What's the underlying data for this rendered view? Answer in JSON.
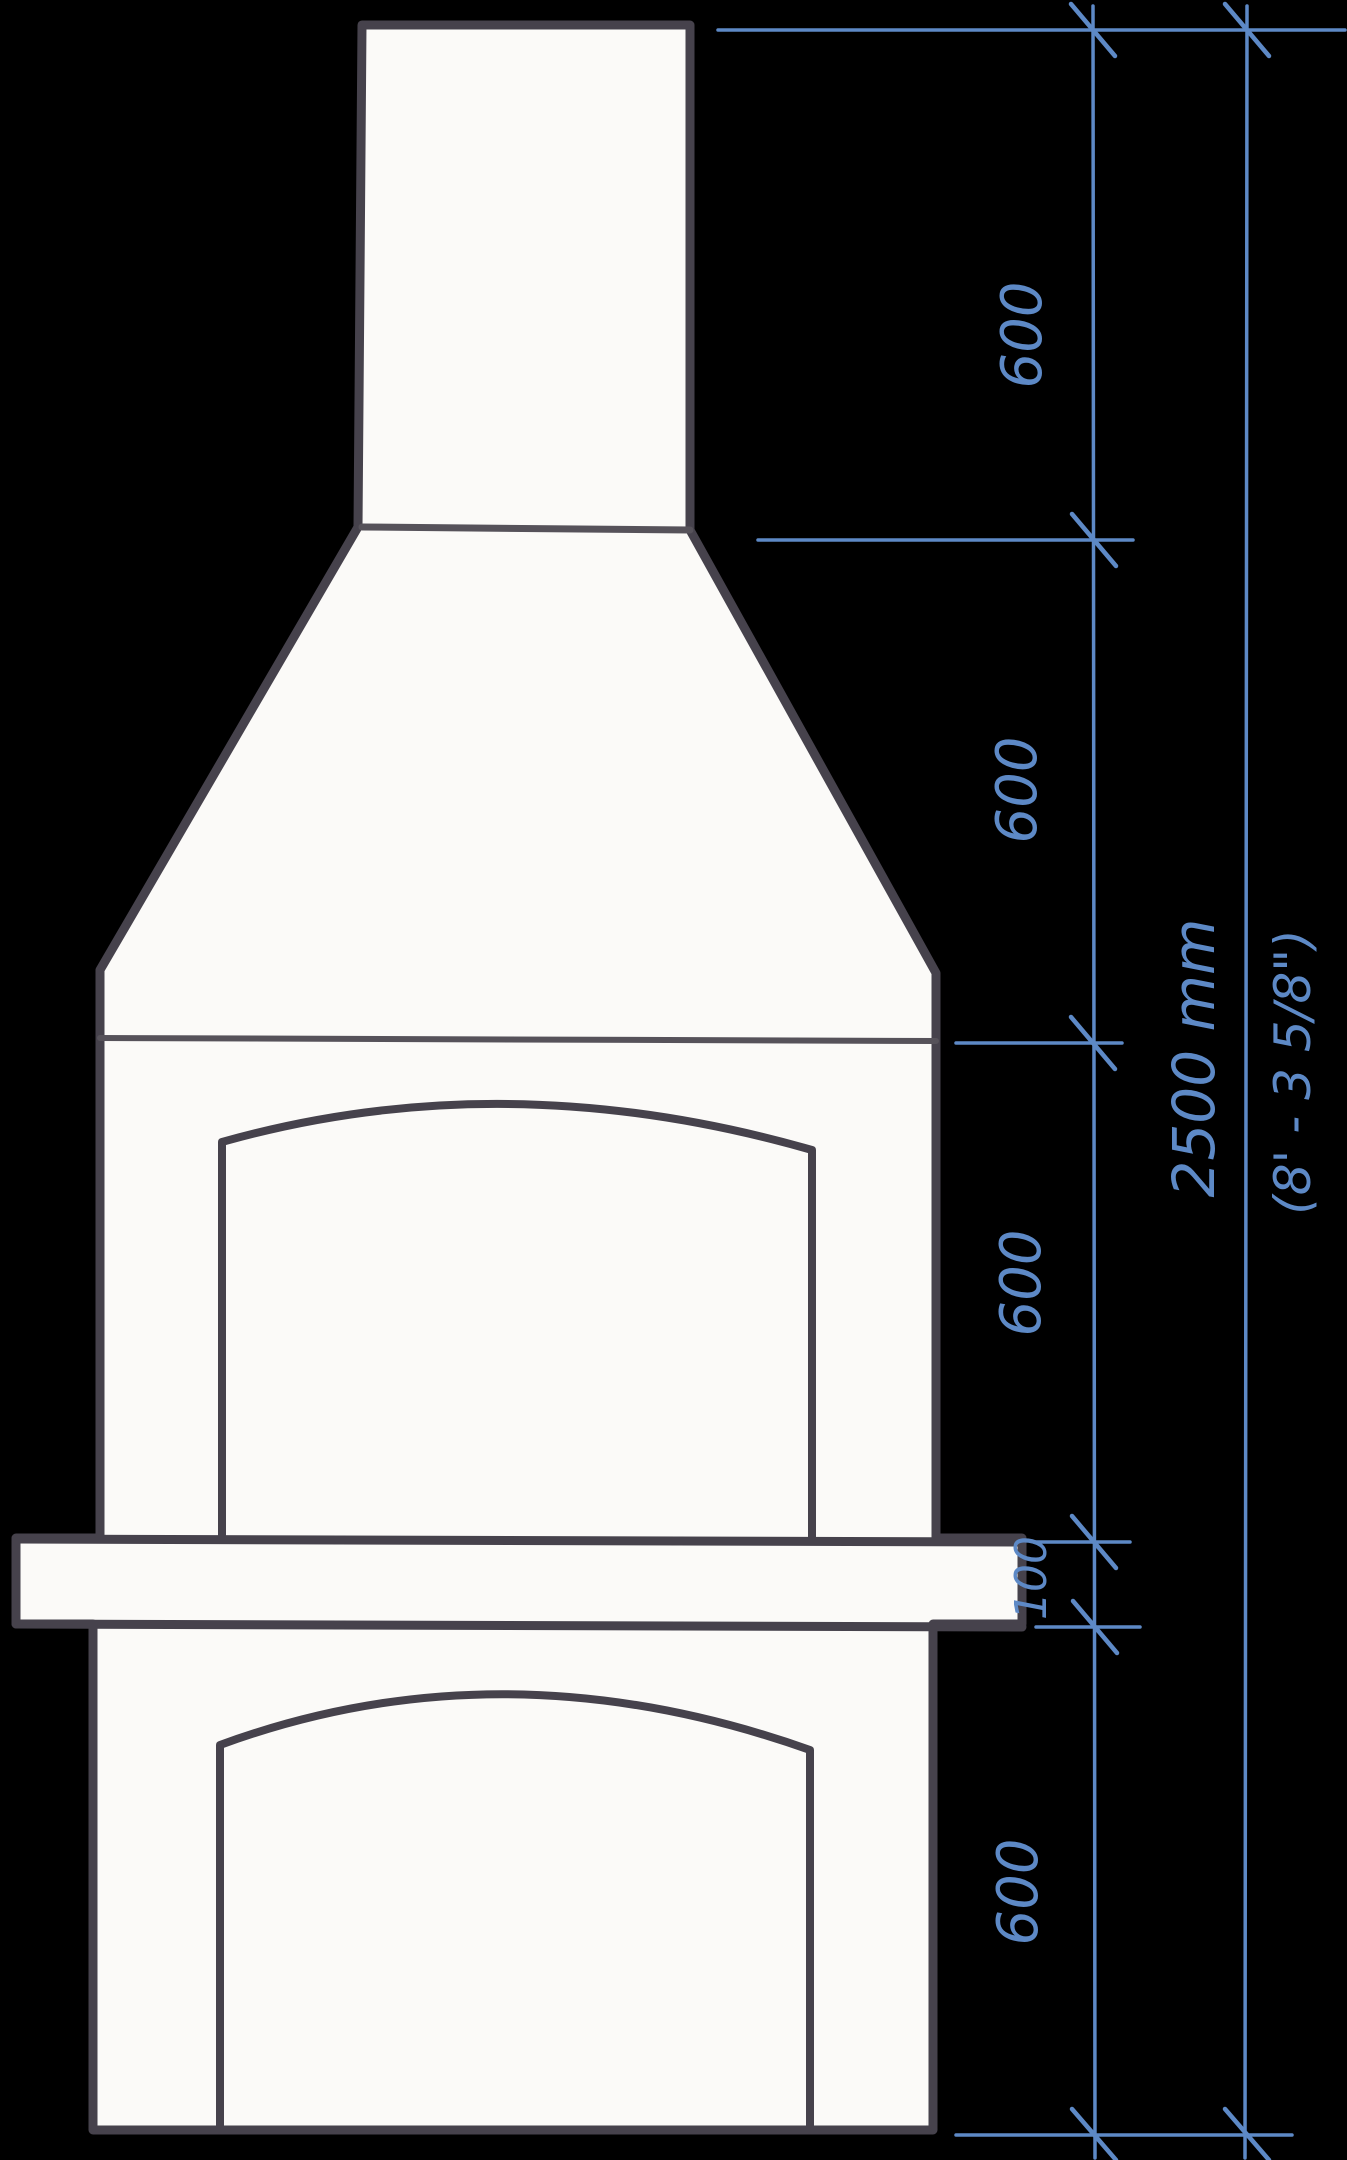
{
  "drawing": {
    "subject": "hand-drawn masonry fireplace / chimney elevation sketch",
    "background_color": "#000000",
    "paper_color": "#fbfaf8",
    "ink_color": "#46424c",
    "pen_color": "#5d89c6"
  },
  "dimensions": {
    "unit": "mm",
    "segment_labels": [
      "600",
      "600",
      "600",
      "100",
      "600"
    ],
    "total_mm_label": "2500 mm",
    "total_imperial_label": "(8' - 3 5/8\")"
  }
}
